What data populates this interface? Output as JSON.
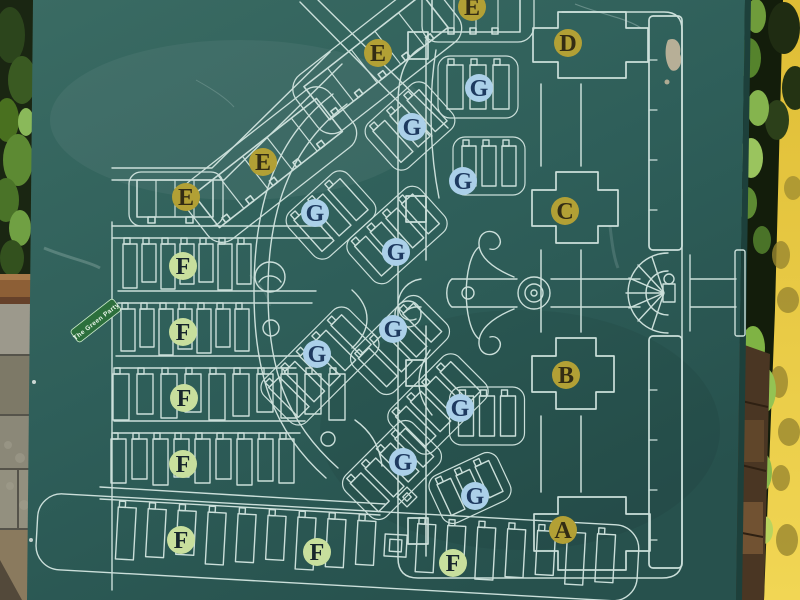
{
  "map_sign": {
    "board_color": "#2e5f5b",
    "line_color": "#cbdfda",
    "sticker": {
      "text": "The Green Party",
      "color": "#2c6f3c"
    },
    "marker_styles": {
      "gold": {
        "fill": "#b2a035",
        "text": "#332c14"
      },
      "green": {
        "fill": "#c8df9d",
        "text": "#17262c"
      },
      "blue": {
        "fill": "#abd0e9",
        "text": "#1e3a60"
      }
    },
    "markers": [
      {
        "label": "E",
        "style": "gold",
        "x": 472,
        "y": 7
      },
      {
        "label": "E",
        "style": "gold",
        "x": 378,
        "y": 53
      },
      {
        "label": "E",
        "style": "gold",
        "x": 263,
        "y": 162
      },
      {
        "label": "E",
        "style": "gold",
        "x": 186,
        "y": 197
      },
      {
        "label": "D",
        "style": "gold",
        "x": 568,
        "y": 43
      },
      {
        "label": "C",
        "style": "gold",
        "x": 565,
        "y": 211
      },
      {
        "label": "B",
        "style": "gold",
        "x": 566,
        "y": 375
      },
      {
        "label": "A",
        "style": "gold",
        "x": 563,
        "y": 530
      },
      {
        "label": "F",
        "style": "green",
        "x": 183,
        "y": 266
      },
      {
        "label": "F",
        "style": "green",
        "x": 183,
        "y": 332
      },
      {
        "label": "F",
        "style": "green",
        "x": 184,
        "y": 398
      },
      {
        "label": "F",
        "style": "green",
        "x": 183,
        "y": 464
      },
      {
        "label": "F",
        "style": "green",
        "x": 181,
        "y": 540
      },
      {
        "label": "F",
        "style": "green",
        "x": 317,
        "y": 552
      },
      {
        "label": "F",
        "style": "green",
        "x": 453,
        "y": 563
      },
      {
        "label": "G",
        "style": "blue",
        "x": 479,
        "y": 88
      },
      {
        "label": "G",
        "style": "blue",
        "x": 412,
        "y": 127
      },
      {
        "label": "G",
        "style": "blue",
        "x": 463,
        "y": 181
      },
      {
        "label": "G",
        "style": "blue",
        "x": 315,
        "y": 213
      },
      {
        "label": "G",
        "style": "blue",
        "x": 396,
        "y": 252
      },
      {
        "label": "G",
        "style": "blue",
        "x": 393,
        "y": 329
      },
      {
        "label": "G",
        "style": "blue",
        "x": 317,
        "y": 354
      },
      {
        "label": "G",
        "style": "blue",
        "x": 460,
        "y": 408
      },
      {
        "label": "G",
        "style": "blue",
        "x": 403,
        "y": 462
      },
      {
        "label": "G",
        "style": "blue",
        "x": 475,
        "y": 496
      }
    ]
  }
}
